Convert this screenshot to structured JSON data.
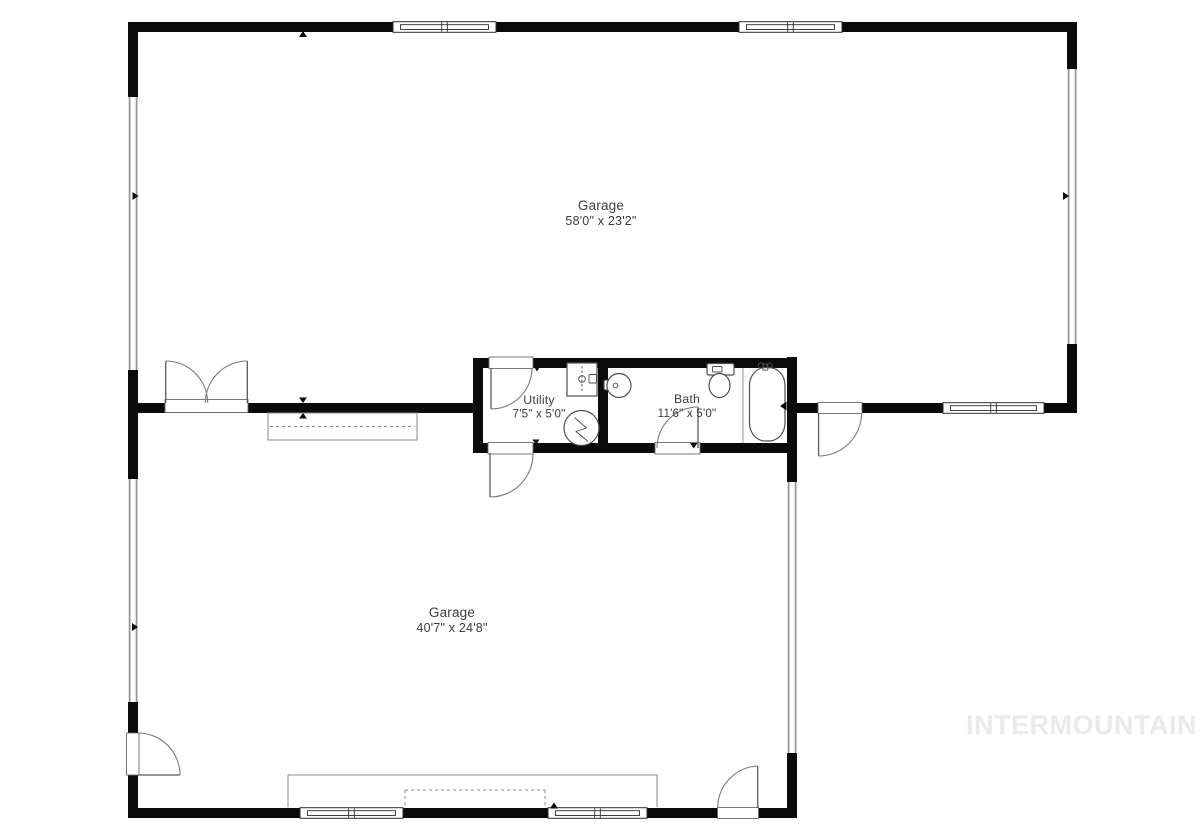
{
  "canvas": {
    "width": 1200,
    "height": 833
  },
  "rooms": {
    "garage_top": {
      "name": "Garage",
      "dims": "58'0\" x 23'2\""
    },
    "utility": {
      "name": "Utility",
      "dims": "7'5\" x 5'0\""
    },
    "bath": {
      "name": "Bath",
      "dims": "11'6\" x 5'0\""
    },
    "garage_bottom": {
      "name": "Garage",
      "dims": "40'7\" x 24'8\""
    }
  },
  "watermark": {
    "text": "INTERMOUNTAIN"
  },
  "colors": {
    "wall": "#0b0b0b",
    "label_text": "#3c3c3c",
    "fixture_stroke": "#4e4e4e",
    "window_frame": "#2e2e2e",
    "side_window_gray": "#969696",
    "garage_door_outline": "#8a8a8a",
    "watermark": "#eaeaea",
    "background": "#ffffff"
  }
}
